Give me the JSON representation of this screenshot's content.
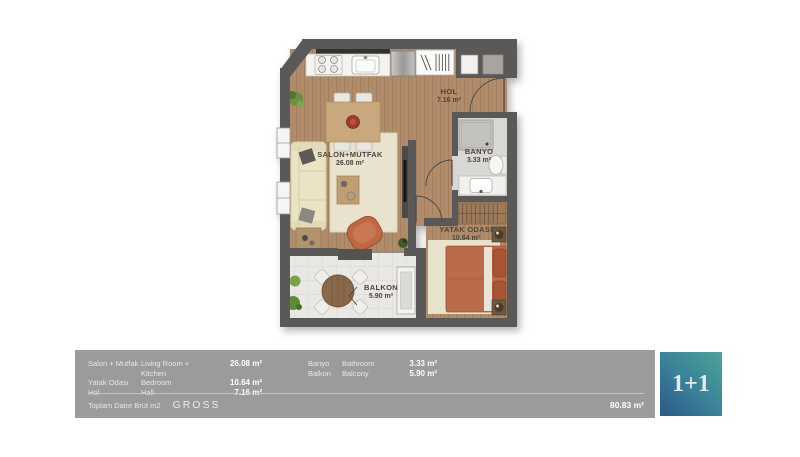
{
  "plan": {
    "rooms": {
      "salon": {
        "name": "SALON+MUTFAK",
        "area": "26.08 m²"
      },
      "hol": {
        "name": "HOL",
        "area": "7.16 m²"
      },
      "banyo": {
        "name": "BANYO",
        "area": "3.33 m²"
      },
      "yatak": {
        "name": "YATAK ODASI",
        "area": "10.64 m²"
      },
      "balkon": {
        "name": "BALKON",
        "area": "5.90 m²"
      }
    }
  },
  "legend": {
    "left_rows": [
      {
        "tr": "Salon + Mutfak",
        "en": "Living Room + Kitchen",
        "value": "26.08 m²"
      },
      {
        "tr": "Yatak Odası",
        "en": "Bedroom",
        "value": "10.64 m²"
      },
      {
        "tr": "Hol",
        "en": "Hall",
        "value": "7.16 m²"
      }
    ],
    "right_rows": [
      {
        "tr": "Banyo",
        "en": "Bathroom",
        "value": "3.33 m²"
      },
      {
        "tr": "Balkon",
        "en": "Balcony",
        "value": "5.90 m²"
      }
    ],
    "total_label_tr": "Toplam Daire Brüt m2",
    "total_label_en": "GROSS",
    "total_value": "80.83 m²",
    "badge": "1+1"
  },
  "colors": {
    "footer_bar": "#9b9b9b",
    "badge_teal": "#47a598",
    "badge_blue": "#2b598c",
    "wall": "#5b5957",
    "wood_floor": "#b08c6b",
    "terracotta": "#b96b4b"
  }
}
